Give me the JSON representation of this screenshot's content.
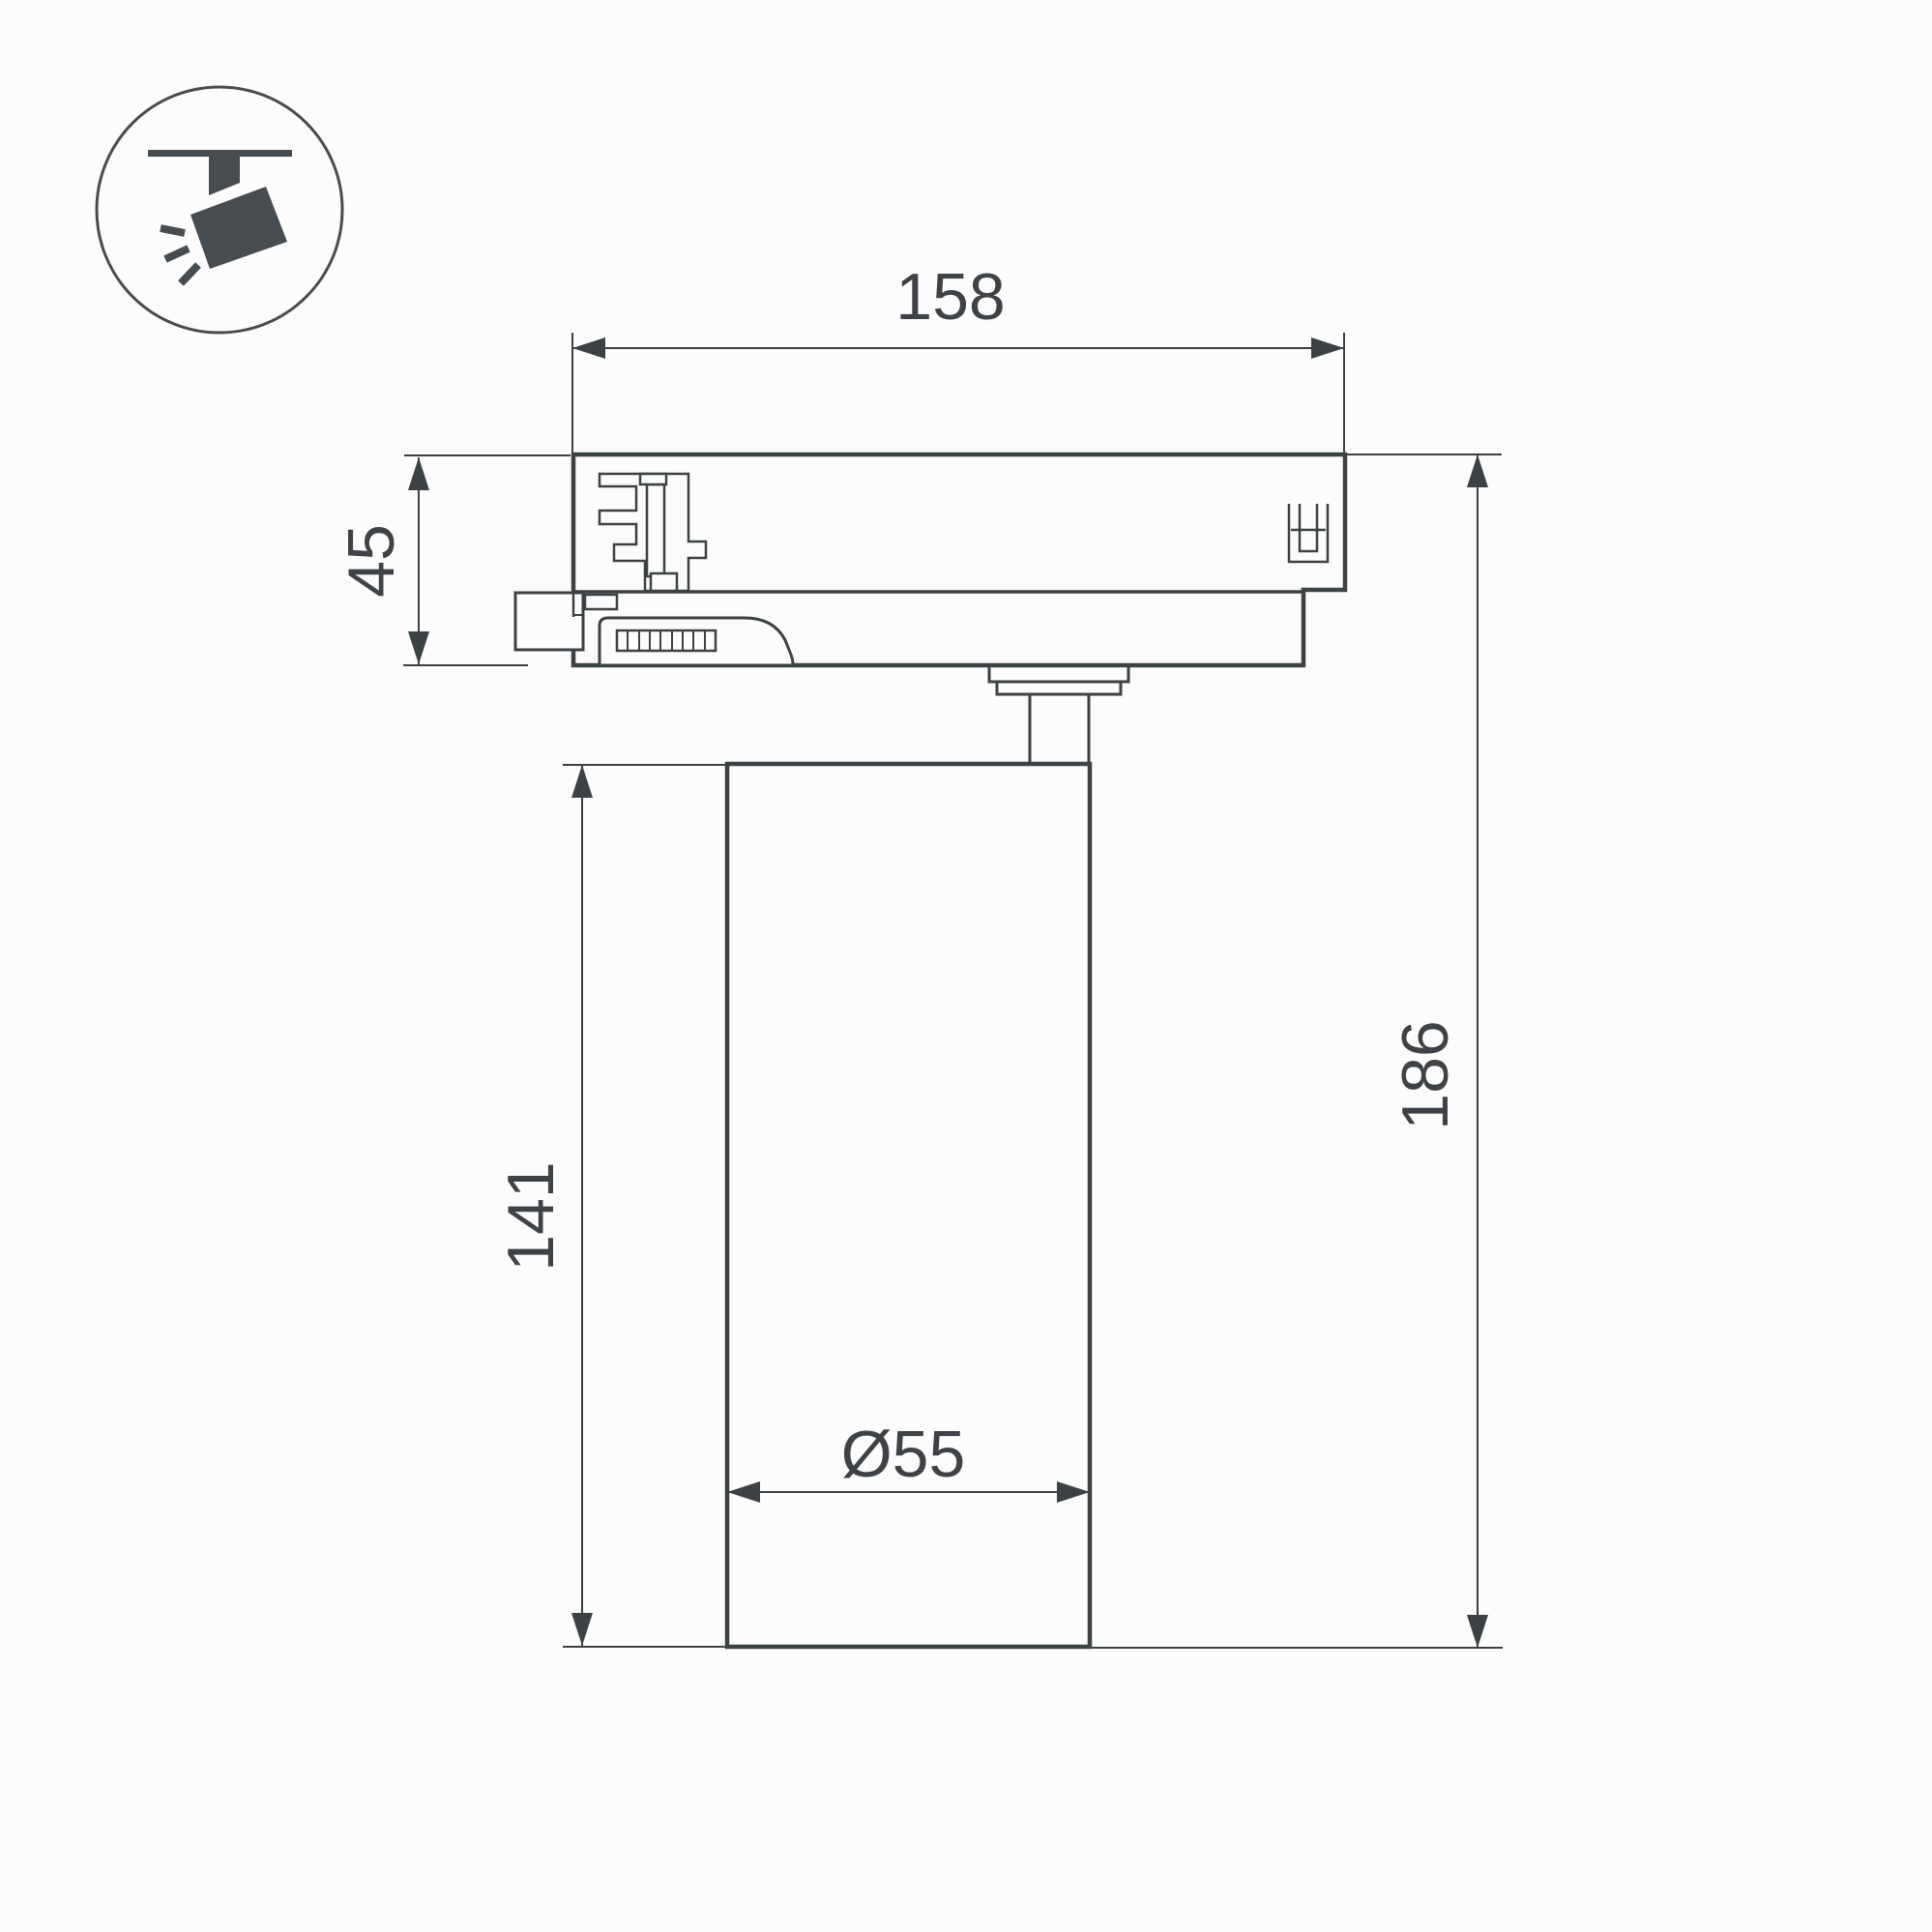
{
  "colors": {
    "background": "#fcfcfc",
    "line": "#3c4144",
    "text": "#3e4246",
    "icon": "#474c50"
  },
  "icon": {
    "name": "track-spotlight-icon"
  },
  "dimensions": {
    "width_top": "158",
    "adapter_height": "45",
    "body_height": "141",
    "overall_height": "186",
    "body_diameter": "Ø55"
  }
}
